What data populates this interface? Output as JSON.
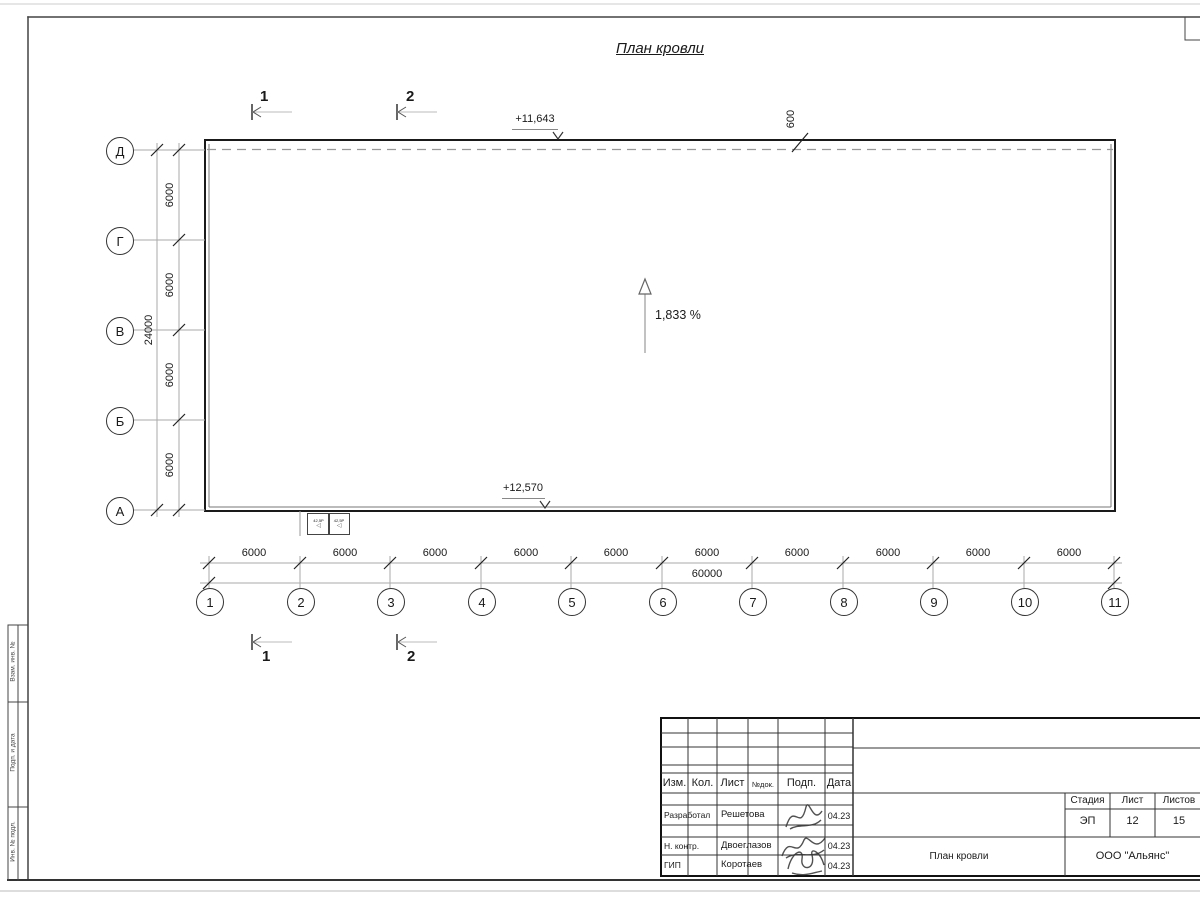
{
  "sheet": {
    "title": "План кровли",
    "slope_label": "1,833 %",
    "elevation_top": "+11,643",
    "elevation_bottom": "+12,570",
    "parapet_offset": "600",
    "section_mark_1": "1",
    "section_mark_2": "2",
    "detail_box_1": "42,5Р",
    "detail_box_2": "42,5Р",
    "detail_arrow": "◁"
  },
  "axes": {
    "rows": [
      "Д",
      "Г",
      "В",
      "Б",
      "А"
    ],
    "cols": [
      "1",
      "2",
      "3",
      "4",
      "5",
      "6",
      "7",
      "8",
      "9",
      "10",
      "11"
    ]
  },
  "dimensions": {
    "row_segments": [
      "6000",
      "6000",
      "6000",
      "6000"
    ],
    "row_total": "24000",
    "col_segments": [
      "6000",
      "6000",
      "6000",
      "6000",
      "6000",
      "6000",
      "6000",
      "6000",
      "6000",
      "6000"
    ],
    "col_total": "60000"
  },
  "frame": {
    "side_labels": [
      "Взам. инв. №",
      "Подп. и дата",
      "Инв. № подл."
    ]
  },
  "titleblock": {
    "header": {
      "izm": "Изм.",
      "kol": "Кол.",
      "list": "Лист",
      "ndok": "№док.",
      "podp": "Подп.",
      "data": "Дата"
    },
    "rows": [
      {
        "role": "Разработал",
        "name": "Решетова",
        "date": "04.23"
      },
      {
        "role": "Н. контр.",
        "name": "Двоеглазов",
        "date": "04.23"
      },
      {
        "role": "ГИП",
        "name": "Коротаев",
        "date": "04.23"
      }
    ],
    "stage": {
      "label": "Стадия",
      "value": "ЭП"
    },
    "sheet_no": {
      "label": "Лист",
      "value": "12"
    },
    "sheets_total": {
      "label": "Листов",
      "value": "15"
    },
    "doc_title": "План кровли",
    "company": "ООО \"Альянс\""
  }
}
